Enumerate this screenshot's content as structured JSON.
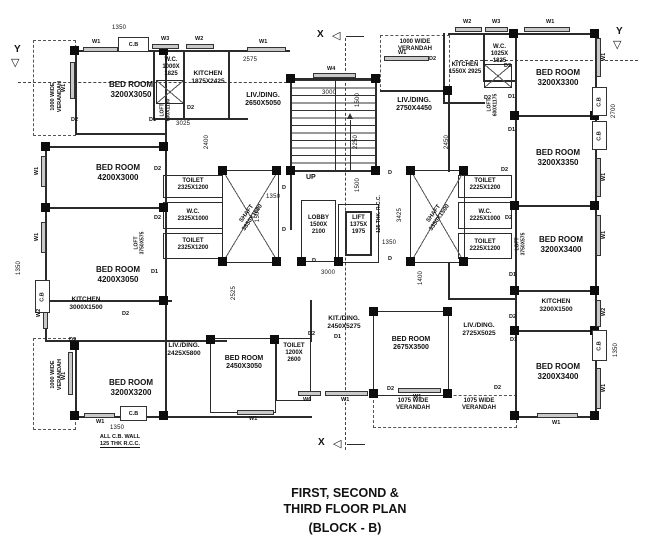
{
  "title": {
    "line1": "FIRST, SECOND &",
    "line2": "THIRD  FLOOR PLAN",
    "line3": "(BLOCK - B)"
  },
  "markers": {
    "x": "X",
    "y": "Y",
    "up": "UP"
  },
  "icons": {
    "tri_down": "▽",
    "tri_left": "◁"
  },
  "tags": {
    "w1": "W1",
    "w2": "W2",
    "w3": "W3",
    "w4": "W4",
    "w6": "W6",
    "d1": "D1",
    "d2": "D2",
    "d": "D",
    "cb": "C.B"
  },
  "rooms": {
    "bedroom_a": {
      "name": "BED ROOM",
      "dims": "3200X3050"
    },
    "bedroom_b": {
      "name": "BED ROOM",
      "dims": "4200X3000"
    },
    "bedroom_c": {
      "name": "BED ROOM",
      "dims": "4200X3050"
    },
    "bedroom_d": {
      "name": "BED ROOM",
      "dims": "3200X3200"
    },
    "bedroom_e": {
      "name": "BED ROOM",
      "dims": "2450X3050"
    },
    "bedroom_f": {
      "name": "BED ROOM",
      "dims": "2675X3500"
    },
    "bedroom_g": {
      "name": "BED ROOM",
      "dims": "3200X3300"
    },
    "bedroom_h": {
      "name": "BED ROOM",
      "dims": "3200X3350"
    },
    "bedroom_i": {
      "name": "BED ROOM",
      "dims": "3200X3400"
    },
    "bedroom_j": {
      "name": "BED ROOM",
      "dims": "3200X3400"
    },
    "kitchen_a": {
      "name": "KITCHEN",
      "dims": "1875X2425"
    },
    "kitchen_b": {
      "name": "KITCHEN",
      "dims": "3000X1500"
    },
    "kitchen_c": {
      "name": "KITCHEN",
      "dims": "1550X 2925"
    },
    "kitchen_d": {
      "name": "KITCHEN",
      "dims": "3200X1500"
    },
    "wc_a": {
      "name": "W.C.",
      "dims": "1000X 1825"
    },
    "wc_b": {
      "name": "W.C.",
      "dims": "2325X1000"
    },
    "wc_c": {
      "name": "W.C.",
      "dims": "1025X 1825"
    },
    "wc_d": {
      "name": "W.C.",
      "dims": "2225X1000"
    },
    "toilet_a": {
      "name": "TOILET",
      "dims": "2325X1200"
    },
    "toilet_b": {
      "name": "TOILET",
      "dims": "2325X1200"
    },
    "toilet_c": {
      "name": "TOILET",
      "dims": "1200X 2600"
    },
    "toilet_d": {
      "name": "TOILET",
      "dims": "2225X1200"
    },
    "toilet_e": {
      "name": "TOILET",
      "dims": "2225X1200"
    },
    "livding_a": {
      "name": "LIV./DING.",
      "dims": "2650X5050"
    },
    "livding_b": {
      "name": "LIV./DING.",
      "dims": "2425X5800"
    },
    "livding_c": {
      "name": "LIV./DING.",
      "dims": "2750X4450"
    },
    "livding_d": {
      "name": "LIV./DING.",
      "dims": "2725X5025"
    },
    "kitding": {
      "name": "KIT./DING.",
      "dims": "2450X5275"
    },
    "lobby": {
      "name": "LOBBY",
      "dims": "1500X 2100"
    },
    "lift": {
      "name": "LIFT",
      "dims": "1375X 1975"
    },
    "shaft_a": {
      "name": "SHAFT",
      "dims": "3850X1600"
    },
    "shaft_b": {
      "name": "SHAFT",
      "dims": "3350X1500"
    }
  },
  "verandahs": {
    "left_top_1": "1000 WIDE",
    "left_top_2": "VERANDAH",
    "left_bot_1": "1000 WIDE",
    "left_bot_2": "VERANDAH",
    "top_right_1": "1000 WIDE",
    "top_right_2": "VERANDAH",
    "bottom_a_1": "1075 WIDE",
    "bottom_a_2": "VERANDAH",
    "bottom_b_1": "1075 WIDE",
    "bottom_b_2": "VERANDAH"
  },
  "lofts": {
    "a": {
      "name": "LOFT",
      "dims": "600X1150"
    },
    "b": {
      "name": "LOFT",
      "dims": "3750X575"
    },
    "c": {
      "name": "LOFT",
      "dims": "600X1175"
    },
    "d": {
      "name": "LOFT",
      "dims": "3750X575"
    }
  },
  "dims": {
    "v1350": "1350",
    "v1400": "1400",
    "v1500": "1500",
    "v2250": "2250",
    "v2400": "2400",
    "v2450": "2450",
    "v2525": "2525",
    "v2575": "2575",
    "v2700": "2700",
    "v3000": "3000",
    "v3025": "3025",
    "v3425": "3425"
  },
  "notes": {
    "cb_wall_1": "ALL C.B. WALL",
    "cb_wall_2": "125 THK  R.C.C.",
    "rcc_vert": "125 THK. R.C.C."
  }
}
